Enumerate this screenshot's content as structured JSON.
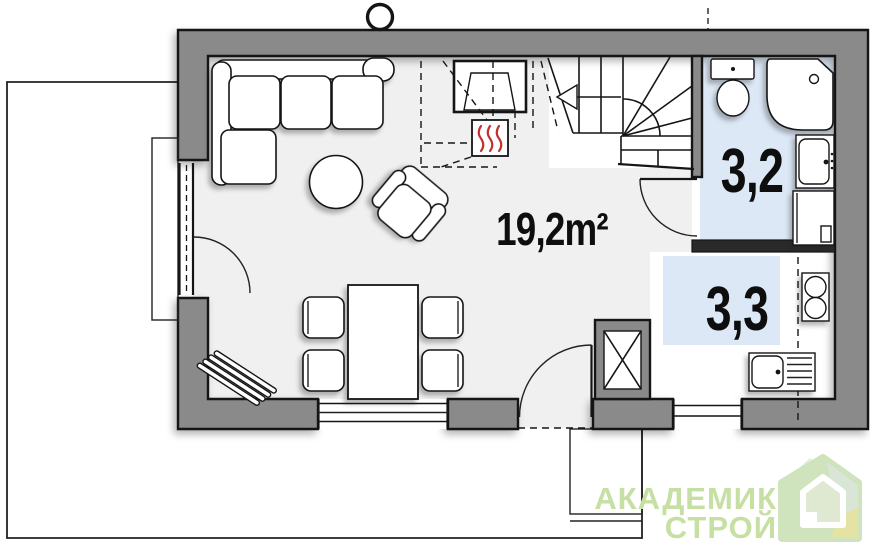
{
  "plan": {
    "rooms": [
      {
        "id": "living-room",
        "area_label": "19,2m²"
      },
      {
        "id": "bathroom",
        "area_label": "3,2"
      },
      {
        "id": "kitchen",
        "area_label": "3,3"
      }
    ],
    "symbols": [
      "chimney-vent-circle",
      "fireplace-heater",
      "loft-outline-dashed",
      "winder-staircase",
      "stair-direction-arrow",
      "terrace-door",
      "entrance-door",
      "bathroom-door",
      "window",
      "corner-sofa",
      "coffee-table",
      "armchair",
      "dining-table",
      "chair",
      "shoe-bench",
      "toilet",
      "corner-bathtub",
      "washbasin",
      "washing-machine",
      "kitchen-sink",
      "stove",
      "terrace-outline",
      "entrance-porch",
      "flue-box"
    ]
  },
  "logo": {
    "line1": "АКАДЕМИК",
    "line2": "СТРОЙ"
  },
  "colors": {
    "wall": "#8a8a8a",
    "interior_wall": "#2a2a2a",
    "line": "#151515",
    "floor": "#f0f0f0",
    "water_room": "#dce8f5",
    "heat_red": "#c4312c",
    "logo_green": "#c6dfa2",
    "icon_green": "#cfe3bd",
    "icon_jade": "#d8e4d9",
    "icon_yellow": "#e5e3a4",
    "icon_pale": "#e4edd9",
    "icon_inner": "#dfe9d2"
  }
}
